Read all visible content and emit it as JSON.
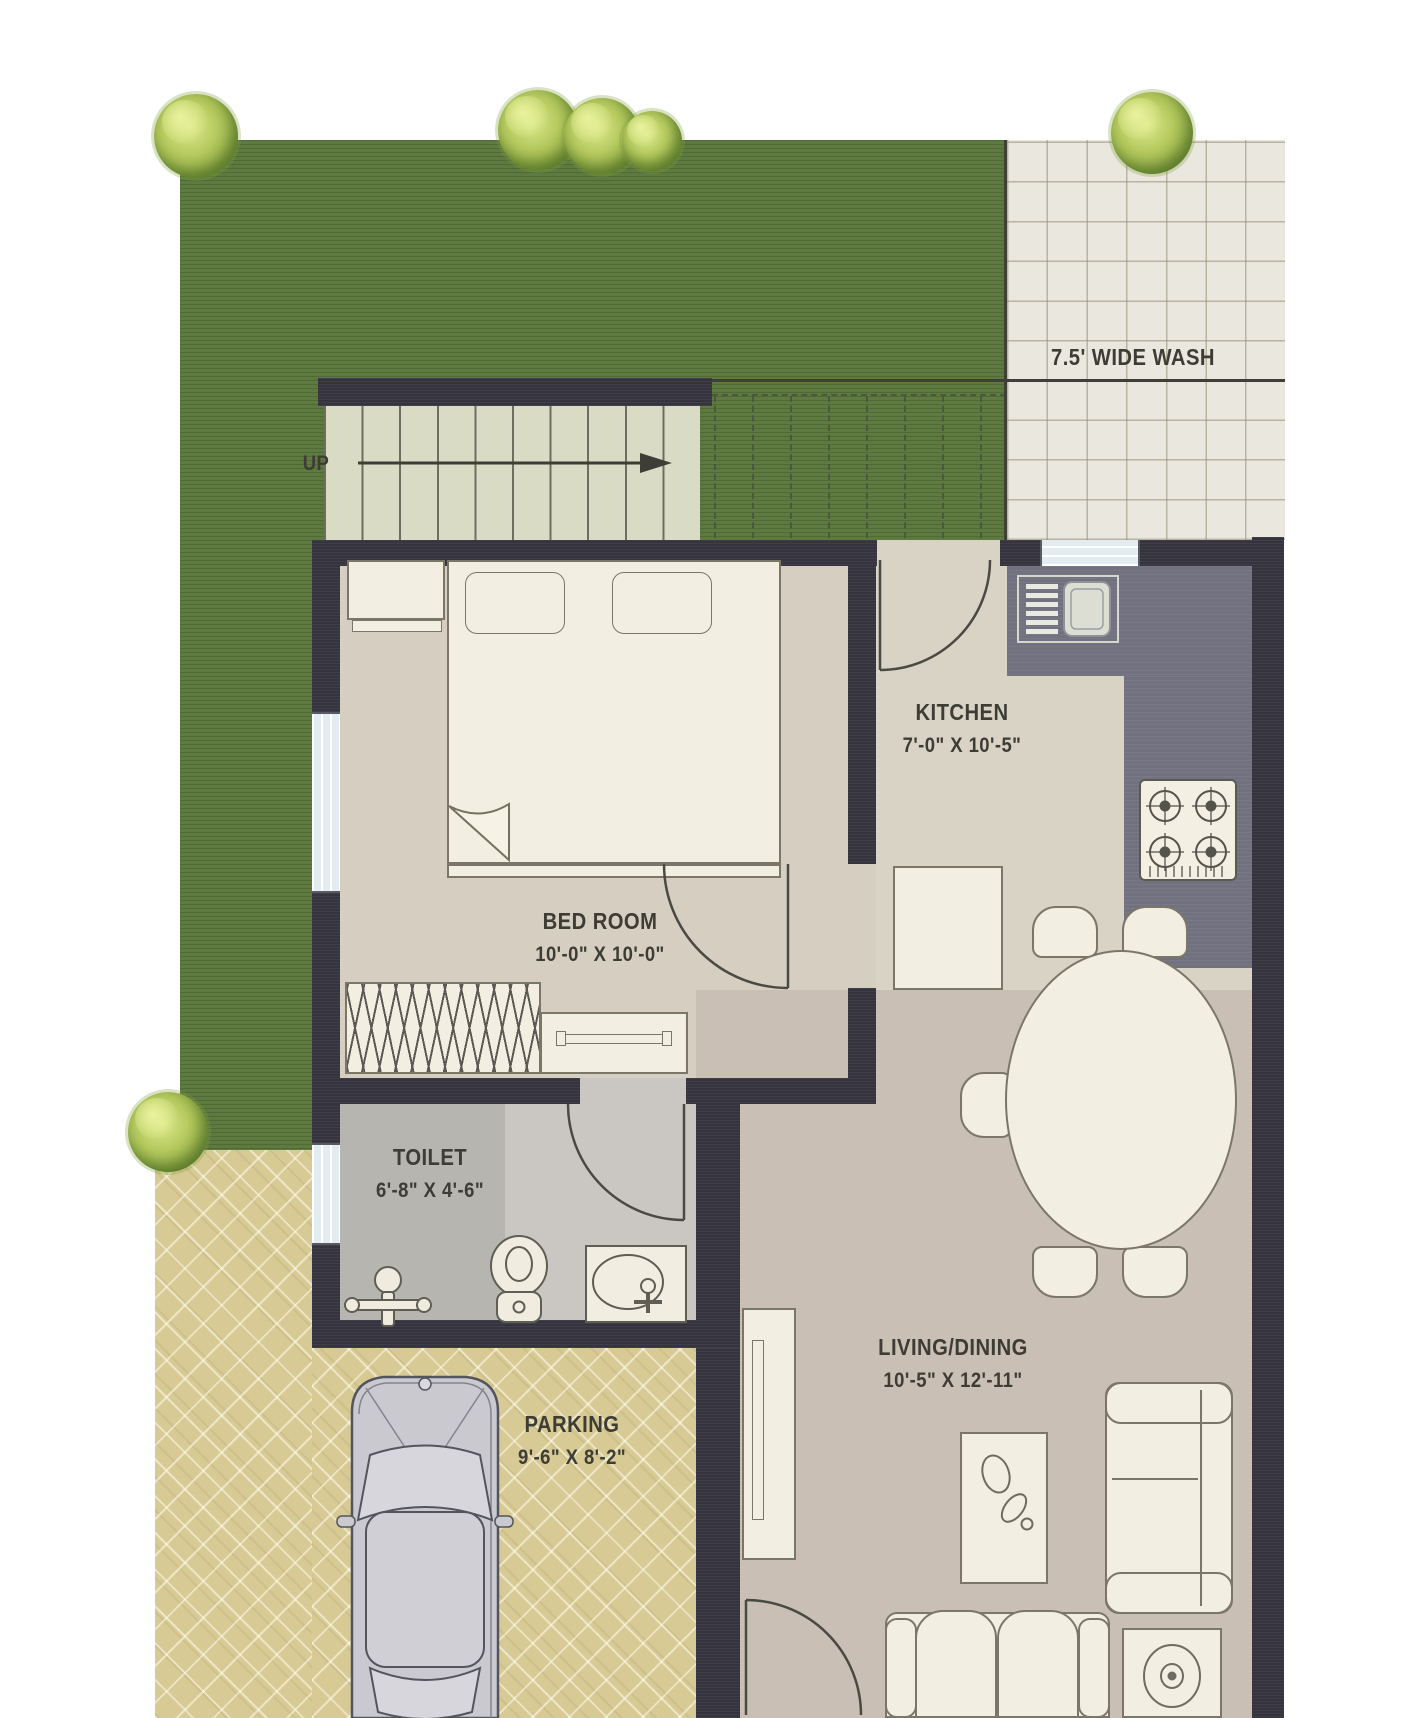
{
  "areas": {
    "wash": {
      "label": "7.5' WIDE WASH"
    },
    "stairs": {
      "label": "UP"
    },
    "kitchen": {
      "name": "KITCHEN",
      "dims": "7'-0\" X 10'-5\""
    },
    "bedroom": {
      "name": "BED ROOM",
      "dims": "10'-0\" X 10'-0\""
    },
    "toilet": {
      "name": "TOILET",
      "dims": "6'-8\" X 4'-6\""
    },
    "living": {
      "name": "LIVING/DINING",
      "dims": "10'-5\" X 12'-11\""
    },
    "parking": {
      "name": "PARKING",
      "dims": "9'-6\" X 8'-2\""
    }
  },
  "colors": {
    "grass": "#5e7a40",
    "wall": "#34333e",
    "wash_tile": "#eae7de",
    "bedroom_floor": "#d6cfc1",
    "kitchen_floor": "#d9d3c5",
    "living_floor": "#cabfb4",
    "toilet_floor_dark": "#b7b5b0",
    "toilet_floor_light": "#cac7c2",
    "counter": "#71717f",
    "parking_paving": "#d8ca94",
    "furniture": "#f2efe2",
    "window_glass": "#e2ecf1",
    "label_text": "#3d3d35"
  }
}
